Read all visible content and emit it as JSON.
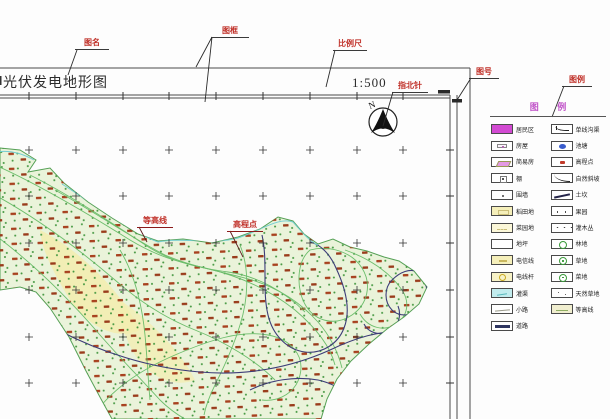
{
  "title_block": {
    "title": "光伏发电地形图",
    "scale": "1:500"
  },
  "north": {
    "label": "N"
  },
  "callouts": {
    "drawing_name": "图名",
    "drawing_frame": "图框",
    "scale_bar": "比例尺",
    "north_arrow": "指北针",
    "drawing_number": "图号",
    "legend": "图例",
    "contour_line": "等高线",
    "elevation_point": "高程点"
  },
  "legend": {
    "header": "图 例",
    "left_items": [
      {
        "label": "居民区",
        "symbol": "magenta-fill"
      },
      {
        "label": "房屋",
        "symbol": "house"
      },
      {
        "label": "简易房",
        "symbol": "shed"
      },
      {
        "label": "棚",
        "symbol": "small-square"
      },
      {
        "label": "围墙",
        "symbol": "dot"
      },
      {
        "label": "稻田地",
        "symbol": "yellow-fill"
      },
      {
        "label": "菜园地",
        "symbol": "yellow-pale"
      },
      {
        "label": "地坪",
        "symbol": "plain"
      },
      {
        "label": "电信线",
        "symbol": "yellow-marks"
      },
      {
        "label": "电线杆",
        "symbol": "pole"
      },
      {
        "label": "灌渠",
        "symbol": "cyan-fill"
      },
      {
        "label": "小路",
        "symbol": "path-line"
      },
      {
        "label": "道路",
        "symbol": "road-line"
      }
    ],
    "right_items": [
      {
        "label": "单线沟渠",
        "symbol": "ditch"
      },
      {
        "label": "池塘",
        "symbol": "pond"
      },
      {
        "label": "高程点",
        "symbol": "elev"
      },
      {
        "label": "自然斜坡",
        "symbol": "slope"
      },
      {
        "label": "土坎",
        "symbol": "bank"
      },
      {
        "label": "果园",
        "symbol": "dots2"
      },
      {
        "label": "灌木丛",
        "symbol": "dots3"
      },
      {
        "label": "林地",
        "symbol": "green-circle"
      },
      {
        "label": "草地",
        "symbol": "green-circle2"
      },
      {
        "label": "菜地",
        "symbol": "green-circle3"
      },
      {
        "label": "天然草地",
        "symbol": "dots-sparse"
      },
      {
        "label": "等高线",
        "symbol": "cream-fill"
      }
    ]
  },
  "colors": {
    "callout-red": "#c03028",
    "legend-magenta": "#c052c8",
    "terrain-fill": "#eaf3da",
    "terrain-edge": "#55a055",
    "contour-green": "#66bb66",
    "index-navy": "#3c3c78",
    "stream-cyan": "#72cdd0",
    "veg-red": "#a8411f",
    "frame-gray": "#4a4a4a"
  }
}
